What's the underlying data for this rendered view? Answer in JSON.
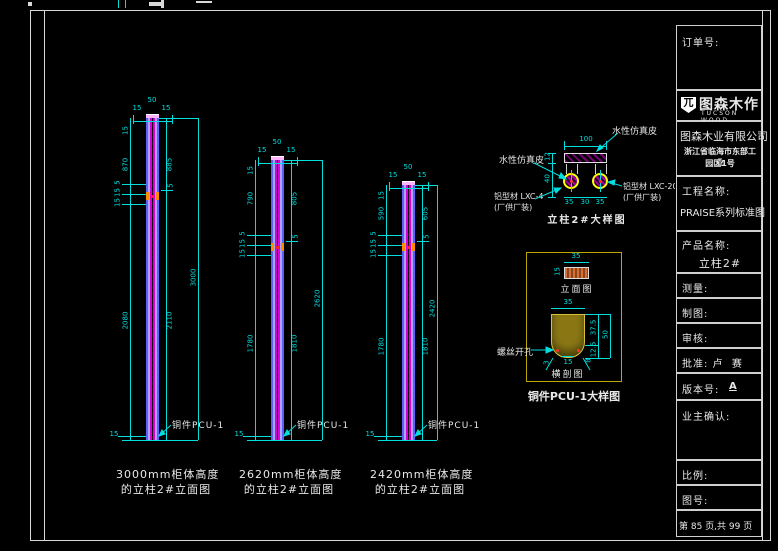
{
  "colors": {
    "background": "#000000",
    "dimension": "#00dede",
    "column_core": "#d800d8",
    "column_edge": "#5e5eff",
    "circle_outline": "#ffff00",
    "connector": "#ff8c00",
    "pcu_box_border": "#b8a800",
    "pcu_section_fill": "#8a7714",
    "text": "#e8e8e8"
  },
  "columns": [
    {
      "top_dims": [
        "15",
        "50",
        "15"
      ],
      "cap": "15",
      "upper": "870",
      "lower": "2080",
      "conn": [
        "5",
        "15",
        "15"
      ],
      "conn_right": "5",
      "inner_upper": "885",
      "inner_lower": "2110",
      "total": "3000",
      "bottom_dim": "15",
      "hardware": "铜件PCU-1",
      "caption1": "3000mm柜体高度",
      "caption2": "的立柱2#立面图"
    },
    {
      "top_dims": [
        "15",
        "50",
        "15"
      ],
      "cap": "15",
      "upper": "790",
      "lower": "1780",
      "conn": [
        "5",
        "15",
        "15"
      ],
      "conn_right": "5",
      "inner_upper": "805",
      "inner_lower": "1810",
      "total": "2620",
      "bottom_dim": "15",
      "hardware": "铜件PCU-1",
      "caption1": "2620mm柜体高度",
      "caption2": "的立柱2#立面图"
    },
    {
      "top_dims": [
        "15",
        "50",
        "15"
      ],
      "cap": "15",
      "upper": "590",
      "lower": "1780",
      "conn": [
        "5",
        "15",
        "15"
      ],
      "conn_right": "5",
      "inner_upper": "605",
      "inner_lower": "1810",
      "total": "2420",
      "bottom_dim": "15",
      "hardware": "铜件PCU-1",
      "caption1": "2420mm柜体高度",
      "caption2": "的立柱2#立面图"
    }
  ],
  "detail_top": {
    "title": "立柱2#大样图",
    "dim_width": "100",
    "dims_bottom": [
      "35",
      "30",
      "35"
    ],
    "dim_plate": "12",
    "dim_leg": "40",
    "label_leather_top": "水性仿真皮",
    "label_leather_left": "水性仿真皮",
    "label_lxc_left1": "铝型材 LXC-4",
    "label_lxc_left2": "(厂供厂装)",
    "label_lxc_right1": "铝型材 LXC-20",
    "label_lxc_right2": "(厂供厂装)"
  },
  "detail_pcu": {
    "title": "铜件PCU-1大样图",
    "elev_label": "立面图",
    "elev_w": "35",
    "elev_h": "15",
    "sect_label": "横剖图",
    "sect_w": "35",
    "sect_inner": "37.5",
    "sect_h": "50",
    "sect_lower": "12.5",
    "sect_bottom": "15",
    "sect_left": "3",
    "sect_right": "8",
    "screw_label": "螺丝开孔"
  },
  "titleblock": {
    "order_label": "订单号:",
    "logo_cn": "图森木作",
    "logo_en": "TUCSON WOOD",
    "logo_mark": "兀",
    "company_name": "图森木业有限公司",
    "company_addr1": "浙江省临海市东部工业",
    "company_addr2": "园区1号",
    "project_label": "工程名称:",
    "project_value": "PRAISE系列标准图",
    "product_label": "产品名称:",
    "product_value": "立柱2#",
    "survey_label": "测量:",
    "draft_label": "制图:",
    "review_label": "审核:",
    "approve_label": "批准: 卢  赛",
    "version_label": "版本号:",
    "version_value": "A",
    "owner_label": "业主确认:",
    "scale_label": "比例:",
    "number_label": "图号:",
    "page_info": "第 85 页,共 99 页"
  }
}
